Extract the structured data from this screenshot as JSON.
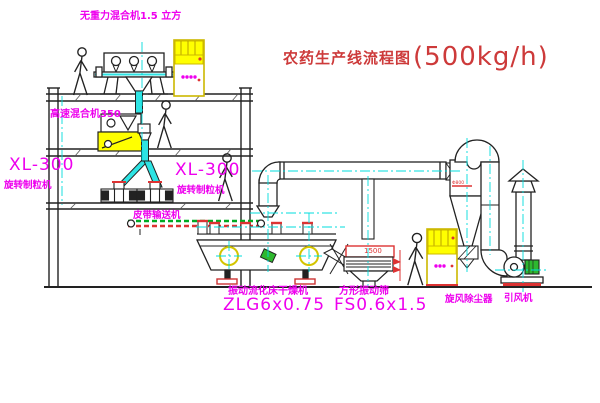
{
  "title": {
    "text": "农药生产线流程图",
    "capacity": "(500kg/h)"
  },
  "labels": {
    "gravity_mixer": "无重力混合机1.5 立方",
    "high_speed_mixer": "高速混合机350",
    "granulator_left_model": "XL-300",
    "granulator_left_name": "旋转制粒机",
    "granulator_right_model": "XL-300",
    "granulator_right_name": "旋转制粒机",
    "belt_conveyor": "皮带输送机",
    "dryer_name": "振动流化床干燥机",
    "dryer_model": "ZLG6x0.75",
    "screen_name": "方形振动筛",
    "screen_model": "FS0.6x1.5",
    "cyclone": "旋风除尘器",
    "fan": "引风机"
  },
  "dimensions": {
    "screen_width": "1500",
    "cyclone_diameter": "Φ800"
  },
  "colors": {
    "line": "#222222",
    "centerline": "#00dcdc",
    "pipe_fill": "#2ee4e4",
    "label_magenta": "#ee00ee",
    "title_red": "#cd3a3a",
    "dimension_red": "#dd3333",
    "cabinet_yellow": "#ffff00",
    "belt_green": "#00aa22",
    "motor_green": "#2eb82e"
  }
}
